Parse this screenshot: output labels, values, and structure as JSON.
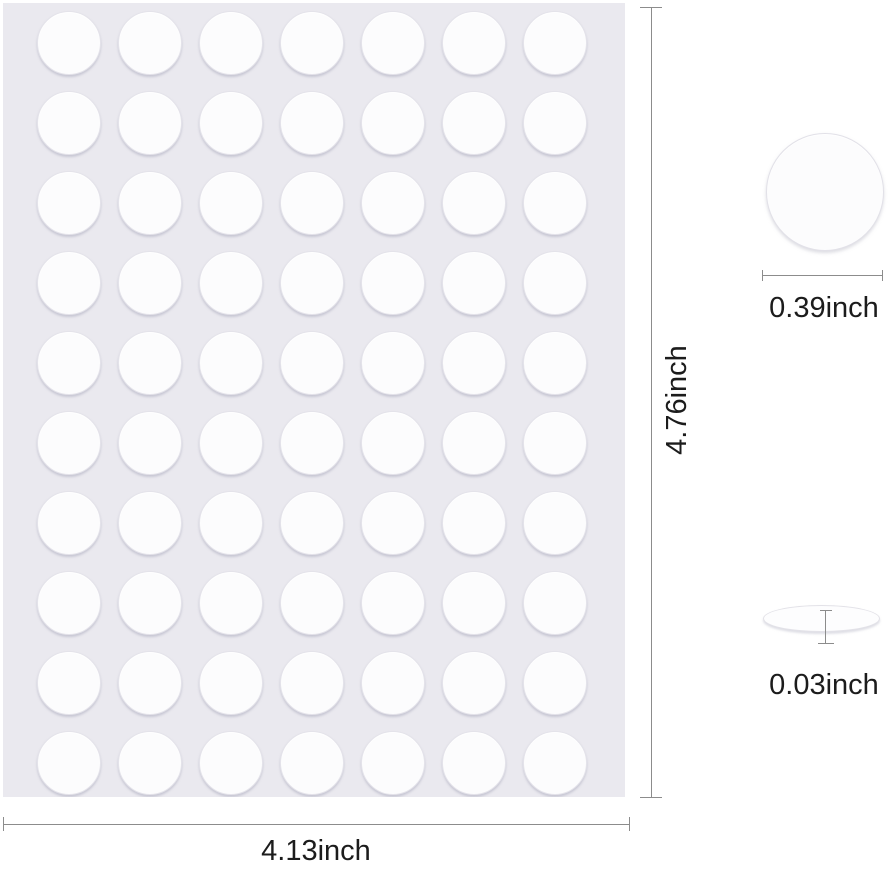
{
  "product": {
    "description": "double-sided adhesive dots sheet dimension diagram"
  },
  "sheet": {
    "grid": {
      "rows": 10,
      "columns": 7,
      "total_dots": 70
    }
  },
  "dimensions": {
    "sheet_width": "4.13inch",
    "sheet_height": "4.76inch",
    "dot_diameter": "0.39inch",
    "dot_thickness": "0.03inch"
  },
  "colors": {
    "sheet_background": "#eae9ef",
    "dot_fill": "#fcfcfd",
    "dimension_line": "#8c8c8c",
    "text": "#1c1c1c",
    "page_background": "#ffffff"
  }
}
